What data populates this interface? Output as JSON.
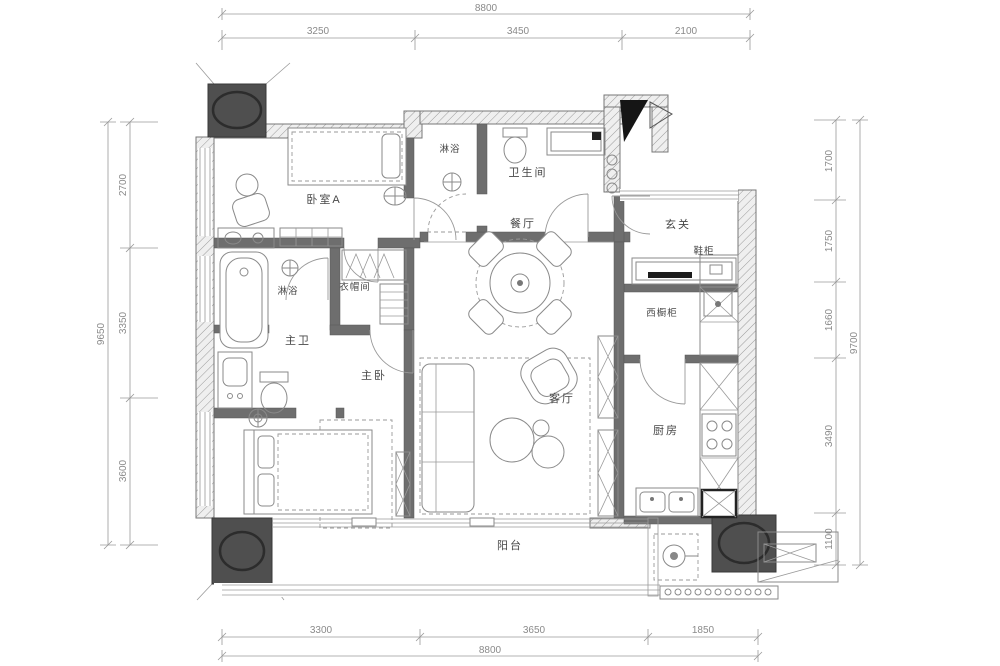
{
  "floorplan": {
    "rooms": {
      "bedroom_a": {
        "label": "卧室A"
      },
      "shower_top": {
        "label": "淋浴"
      },
      "wc": {
        "label": "卫生间"
      },
      "dining": {
        "label": "餐厅"
      },
      "entry": {
        "label": "玄关"
      },
      "shoe_cabinet": {
        "label": "鞋柜"
      },
      "west_cabinet": {
        "label": "西橱柜"
      },
      "kitchen": {
        "label": "厨房"
      },
      "master_bath": {
        "label": "主卫"
      },
      "master_shower": {
        "label": "淋浴"
      },
      "closet": {
        "label": "衣帽间"
      },
      "master_bedroom": {
        "label": "主卧"
      },
      "living": {
        "label": "客厅"
      },
      "balcony": {
        "label": "阳台"
      }
    },
    "dimensions": {
      "top": {
        "total": "8800",
        "segments": [
          "3250",
          "3450",
          "2100"
        ]
      },
      "bottom": {
        "total": "8800",
        "segments": [
          "3300",
          "3650",
          "1850"
        ]
      },
      "left": {
        "total": "9650",
        "segments": [
          "2700",
          "3350",
          "3600"
        ]
      },
      "right": {
        "total": "9700",
        "segments": [
          "1700",
          "1750",
          "1660",
          "3490",
          "1100"
        ]
      }
    },
    "colors": {
      "wall_fill": "#6e6e6e",
      "column_fill": "#4f4f4f",
      "line": "#8a8a8a",
      "dim_text": "#8a8a8a",
      "background": "#ffffff"
    }
  }
}
